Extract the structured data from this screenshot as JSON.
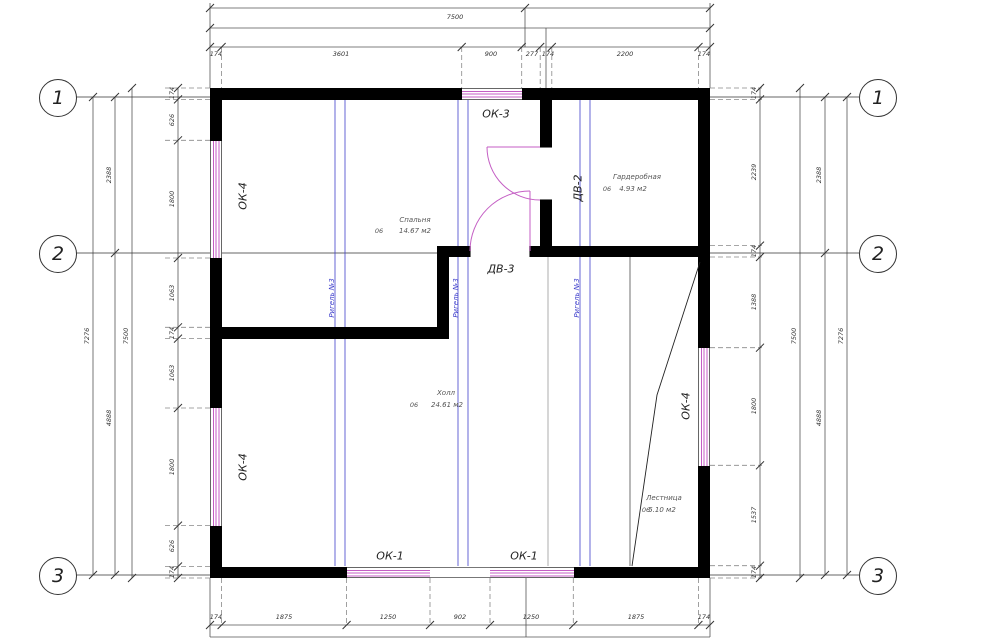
{
  "drawing": {
    "axes": [
      "1",
      "2",
      "3"
    ],
    "dims": {
      "top": {
        "overall": "7500",
        "detail": [
          "174",
          "3601",
          "900",
          "277",
          "174",
          "2200",
          "174"
        ]
      },
      "bottom": {
        "detail": [
          "174",
          "1875",
          "1250",
          "902",
          "1250",
          "1875",
          "174"
        ]
      },
      "left": {
        "outer": "7276",
        "overall": "7500",
        "segments": [
          "2388",
          "4888"
        ],
        "detail": [
          "174",
          "626",
          "1800",
          "1063",
          "174",
          "1063",
          "1800",
          "626",
          "174"
        ]
      },
      "right": {
        "outer": "7276",
        "overall": "7500",
        "segments": [
          "2388",
          "4888"
        ],
        "detail": [
          "174",
          "2239",
          "174",
          "1388",
          "1800",
          "1537",
          "174"
        ]
      }
    },
    "rooms": [
      {
        "num": "06",
        "name": "Спальня",
        "area": "14.67 м2"
      },
      {
        "num": "06",
        "name": "Гардеробная",
        "area": "4.93 м2"
      },
      {
        "num": "06",
        "name": "Холл",
        "area": "24.61 м2"
      },
      {
        "num": "06",
        "name": "Лестница",
        "area": "5.10 м2"
      }
    ],
    "openings": {
      "ok3": "ОК-3",
      "ok1": "ОК-1",
      "ok4": "ОК-4",
      "dv2": "ДВ-2",
      "dv3": "ДВ-3"
    },
    "beam": {
      "label": "Ригель №3"
    },
    "colors": {
      "wall": "#000000",
      "window": "#c45ec4",
      "door_arc": "#c45ec4",
      "beam_line": "#4040cc",
      "thin_line": "#555555"
    }
  }
}
